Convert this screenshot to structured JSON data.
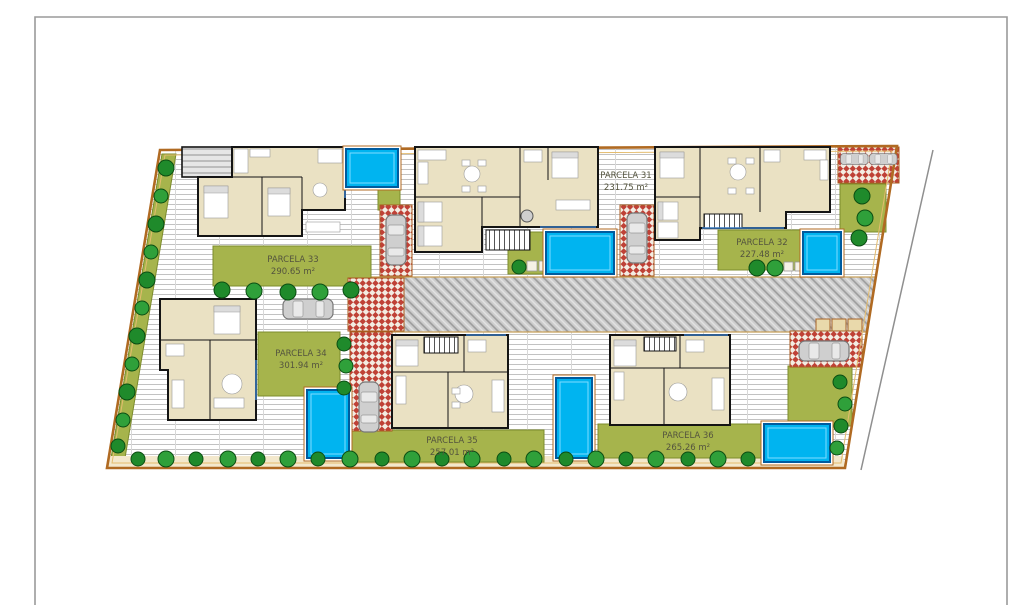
{
  "plan_type": "residential-site-plan",
  "parcels": [
    {
      "name": "PARCELA 33",
      "area": "290.65 m²",
      "position": "top-left"
    },
    {
      "name": "PARCELA 31",
      "area": "231.75 m²",
      "position": "top-center"
    },
    {
      "name": "PARCELA 32",
      "area": "227.48 m²",
      "position": "top-right"
    },
    {
      "name": "PARCELA 34",
      "area": "301.94 m²",
      "position": "bottom-left"
    },
    {
      "name": "PARCELA 35",
      "area": "257.01 m²",
      "position": "bottom-center"
    },
    {
      "name": "PARCELA 36",
      "area": "265.26 m²",
      "position": "bottom-right"
    }
  ],
  "features": {
    "villas": 6,
    "pools": 6,
    "cars": 7,
    "central_road": "shared paved driveway between parcel rows"
  },
  "colors": {
    "pool": "#00b4f0",
    "garden_green": "#a6b44c",
    "tree_green": "#1f8a2b",
    "driveway_red": "#bf4136",
    "boundary_orange": "#b06a22",
    "road_gray": "#adadad",
    "house_fill": "#eae1c3",
    "house_wall": "#141414",
    "frame_gray": "#9a9a9a"
  }
}
